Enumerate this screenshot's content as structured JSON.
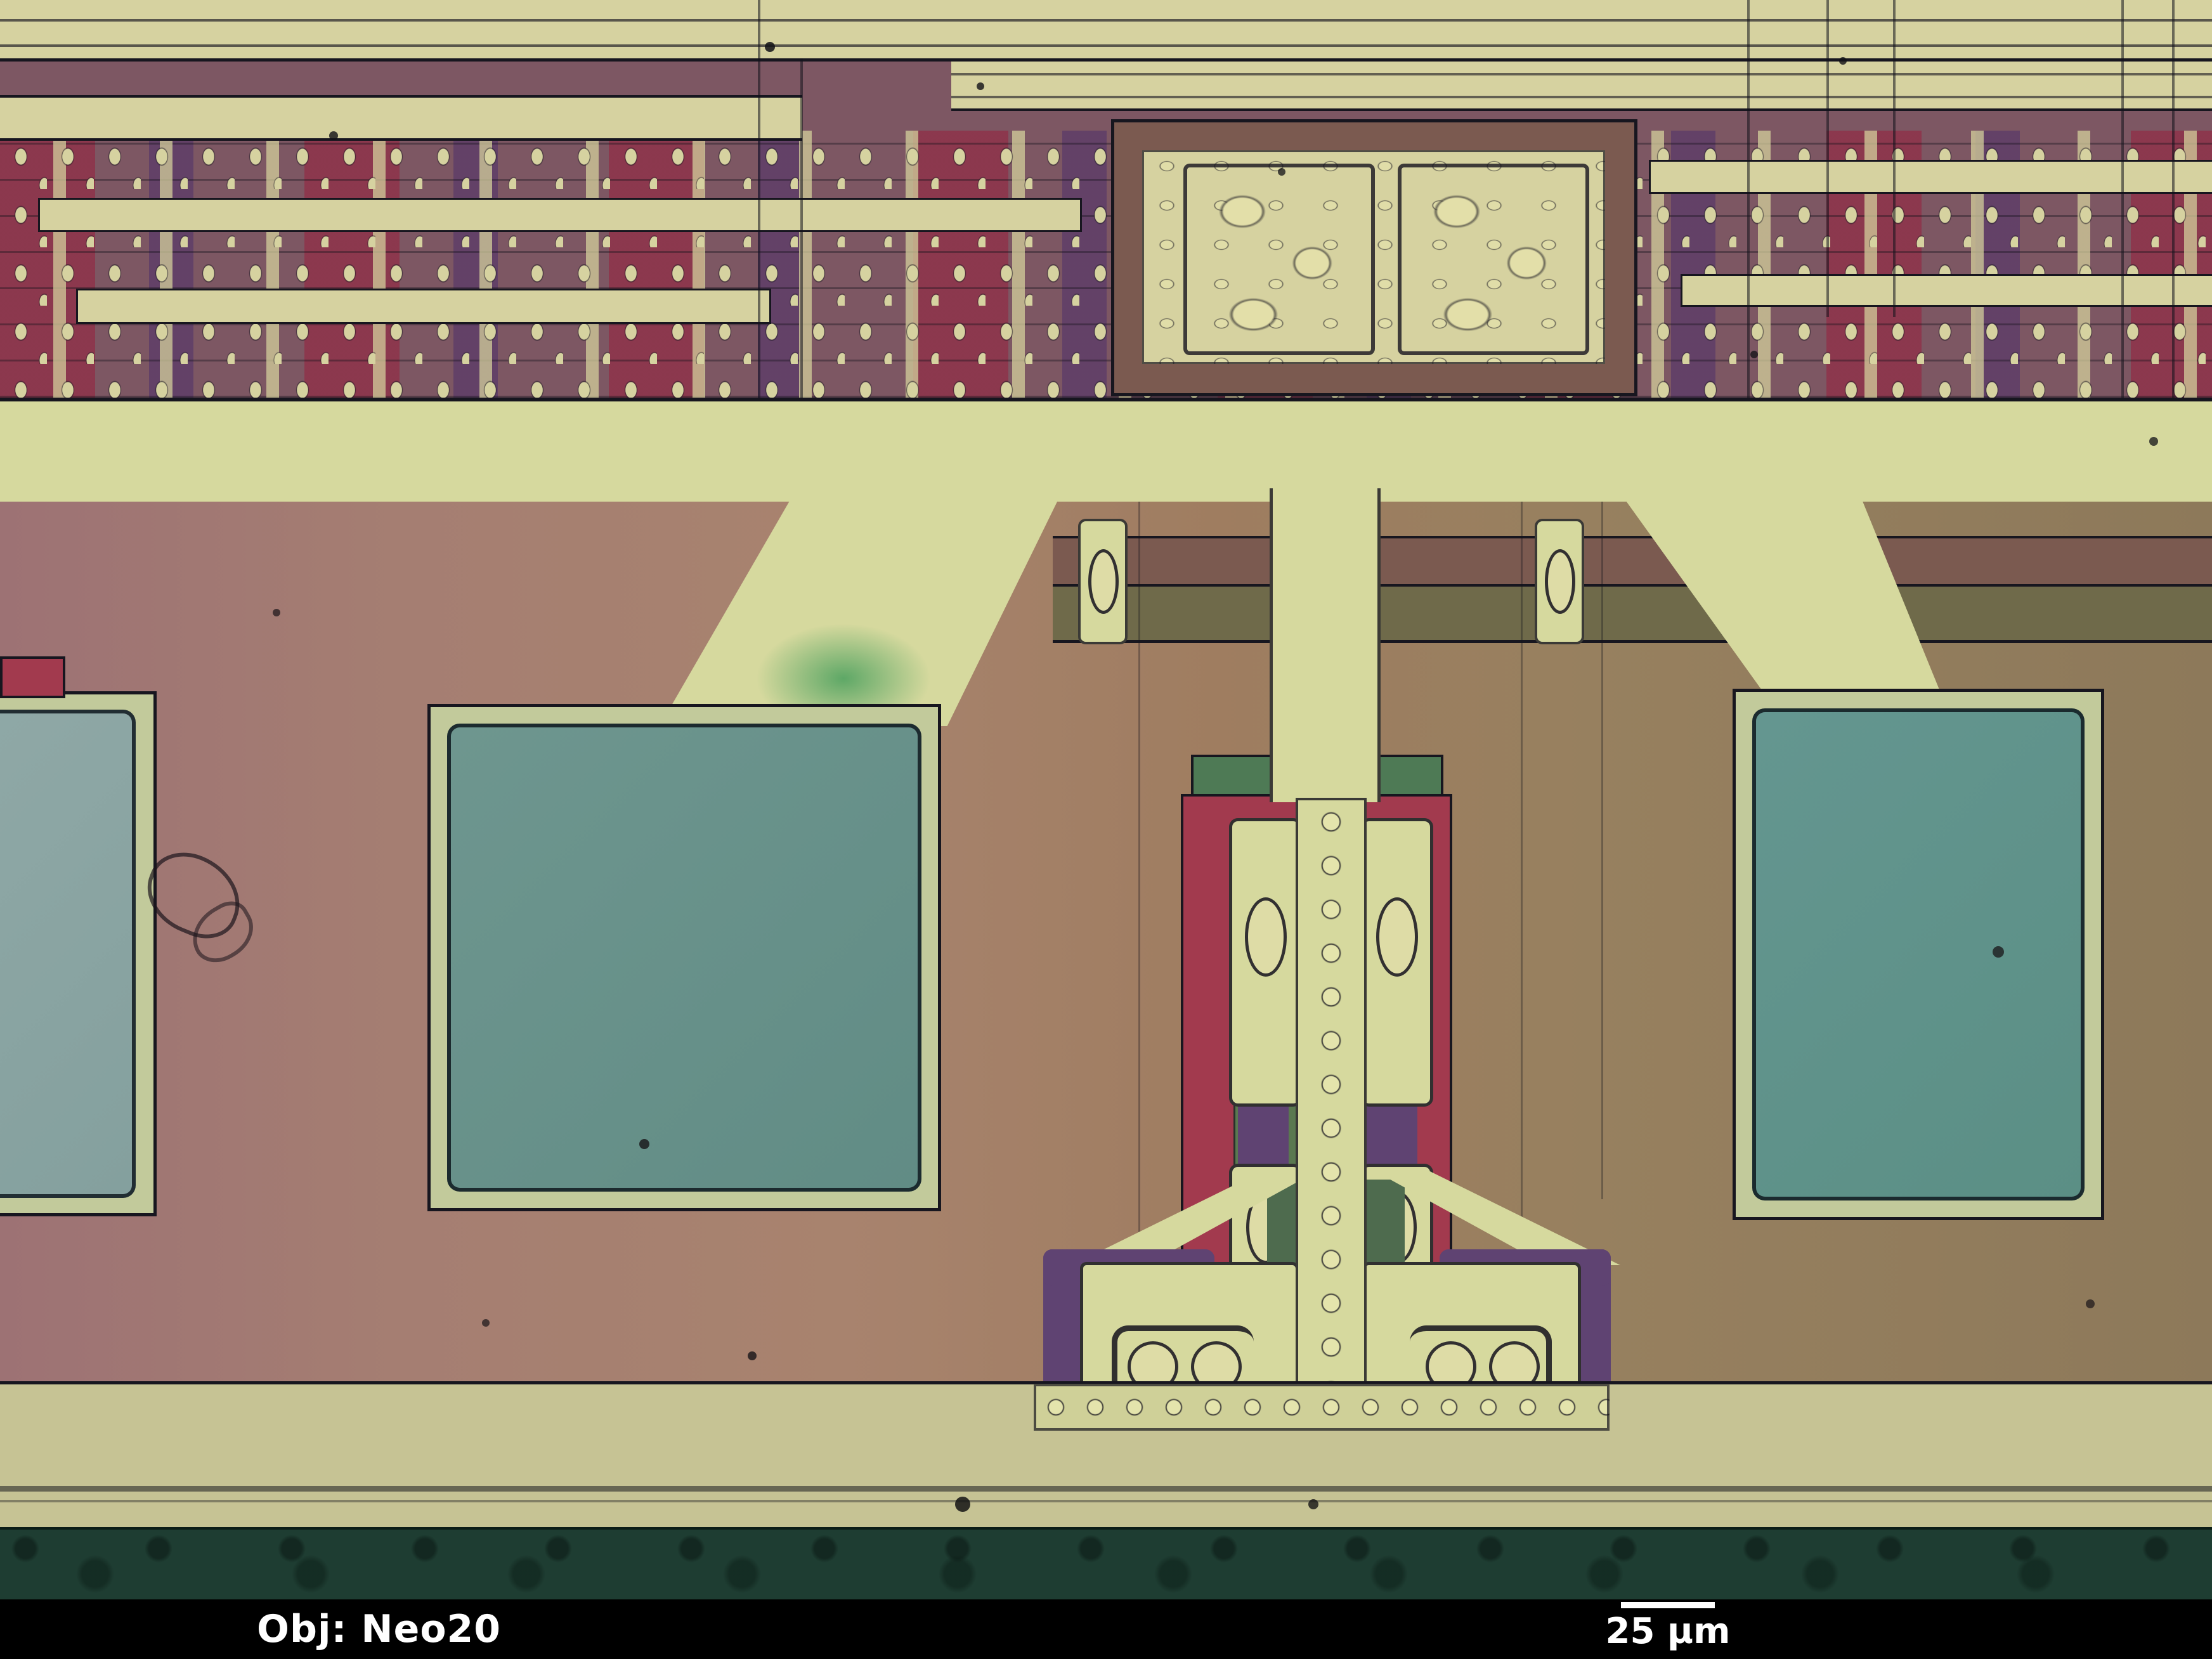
{
  "overlay": {
    "objective_label": "Obj: Neo20",
    "scale_bar_label": "25 µm"
  },
  "palette": {
    "metal_cream": "#d6d2a0",
    "band_yellow": "#d6d99e",
    "mauve": "#7d5763",
    "red_implant": "#a23a4e",
    "crimson_cell": "#8f3048",
    "purple": "#5f4372",
    "teal_pad": "#679290",
    "teal_pad_light": "#8aa3a2",
    "pad_rim": "#c2ca9b",
    "green_diff": "#4e7a55",
    "green_blob": "#57a563",
    "mid_pink": "#a17a70",
    "mid_tan": "#947a5c",
    "brown_trace": "#7b5a50",
    "olive_trace": "#6f6a4a",
    "bottom_band": "#c6c394",
    "dark_green_strip": "#1e3d32",
    "info_bar_bg": "#000000",
    "info_text": "#ffffff",
    "outline_dark": "#17161f"
  }
}
